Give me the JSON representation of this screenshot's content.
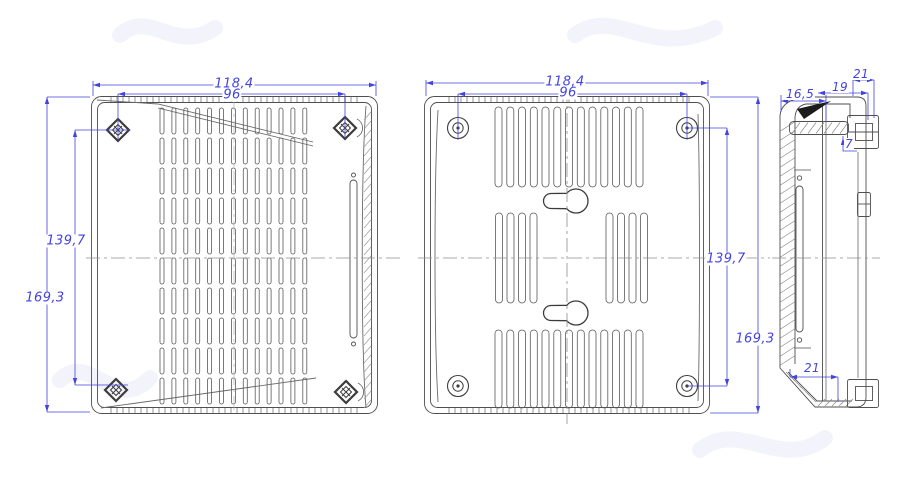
{
  "drawing": {
    "front_view": {
      "dim_width_outer": "118,4",
      "dim_width_screws": "96",
      "dim_height_screws": "139,7",
      "dim_height_outer": "169,3",
      "rib_count": 13,
      "rib_segments": 10
    },
    "back_view": {
      "dim_width_outer": "118,4",
      "dim_width_bosses": "96",
      "dim_height_bosses": "139,7",
      "dim_height_outer": "169,3",
      "slot_count_top": 13,
      "slot_count_bottom": 13,
      "slot_count_mid_left": 4,
      "slot_count_mid_right": 4
    },
    "side_view": {
      "dim_depth_body": "16,5",
      "dim_depth_step": "19",
      "dim_depth_total": "21",
      "dim_clip_height": "7",
      "dim_bottom_width": "21"
    },
    "colors": {
      "dimension_blue": "#4343e0",
      "outline_dark": "#4f4f4f",
      "outline_light": "#9a9a9a",
      "centerline_gray": "#8d8d8d"
    }
  }
}
